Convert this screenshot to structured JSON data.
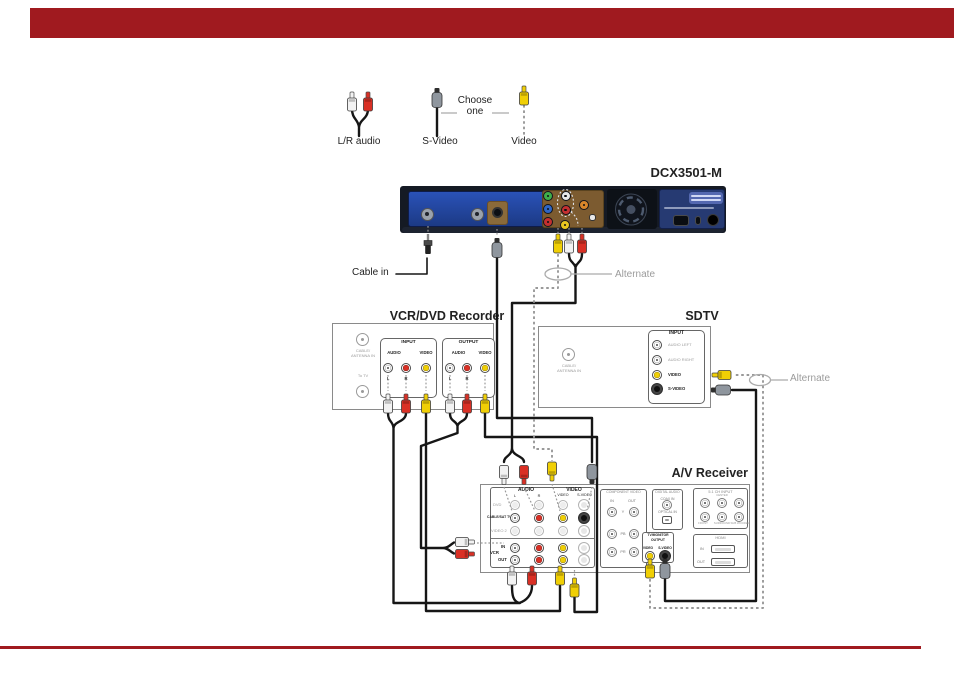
{
  "page": {
    "accent_red": "#a01a1f",
    "background": "#ffffff"
  },
  "palette": {
    "cable_black": "#161616",
    "dotted_gray": "#999999",
    "rca_white": "#f2f2f2",
    "rca_red": "#d93025",
    "rca_yellow": "#f0cf05",
    "svideo_gray": "#8f969e",
    "dcx_panel_blue": "#2a52b8"
  },
  "legend": {
    "lr_audio": "L/R audio",
    "s_video": "S-Video",
    "choose_one": "Choose one",
    "video": "Video"
  },
  "dcx": {
    "model": "DCX3501-M",
    "cable_in": "Cable in",
    "alternate": "Alternate"
  },
  "recorder": {
    "title": "VCR/DVD Recorder",
    "cable_antenna_1": "CABLE/",
    "cable_antenna_2": "ANTENNA IN",
    "to_tv": "To TV",
    "input": "INPUT",
    "output": "OUTPUT",
    "audio": "AUDIO",
    "video": "VIDEO",
    "left": "L",
    "right": "R"
  },
  "sdtv": {
    "title": "SDTV",
    "input": "INPUT",
    "audio_left": "AUDIO LEFT",
    "audio_right": "AUDIO RIGHT",
    "video": "VIDEO",
    "s_video": "S-VIDEO",
    "cable_antenna_1": "CABLE/",
    "cable_antenna_2": "ANTENNA IN",
    "alternate": "Alternate"
  },
  "receiver": {
    "title": "A/V Receiver",
    "audio": "AUDIO",
    "video_group": "VIDEO",
    "left": "L",
    "right": "R",
    "video_col": "VIDEO",
    "s_video_col": "S-VIDEO",
    "row_dvd": "DVD",
    "row_cable_sat": "CABLE/SAT TV",
    "row_video2": "VIDEO 2",
    "vcr": "VCR",
    "in": "IN",
    "out": "OUT",
    "component_video": "COMPONENT VIDEO",
    "comp_in": "IN",
    "comp_out": "OUT",
    "y": "Y",
    "pb": "PB",
    "pr": "PR",
    "digital_audio": "DIGITAL AUDIO",
    "coax_in": "COAX IN",
    "optical_in": "OPTICAL IN",
    "tv_monitor_1": "TV/MONITOR",
    "tv_monitor_2": "OUTPUT",
    "tvm_video": "VIDEO",
    "tvm_s_video": "S-VIDEO",
    "ch_51": "5.1 CH INPUT",
    "ch_labels": [
      "FRONT",
      "CENTER",
      "SURROUND",
      "SUB WOOFER"
    ],
    "hdmi": "HDMI",
    "hdmi_in": "IN",
    "hdmi_out": "OUT"
  }
}
